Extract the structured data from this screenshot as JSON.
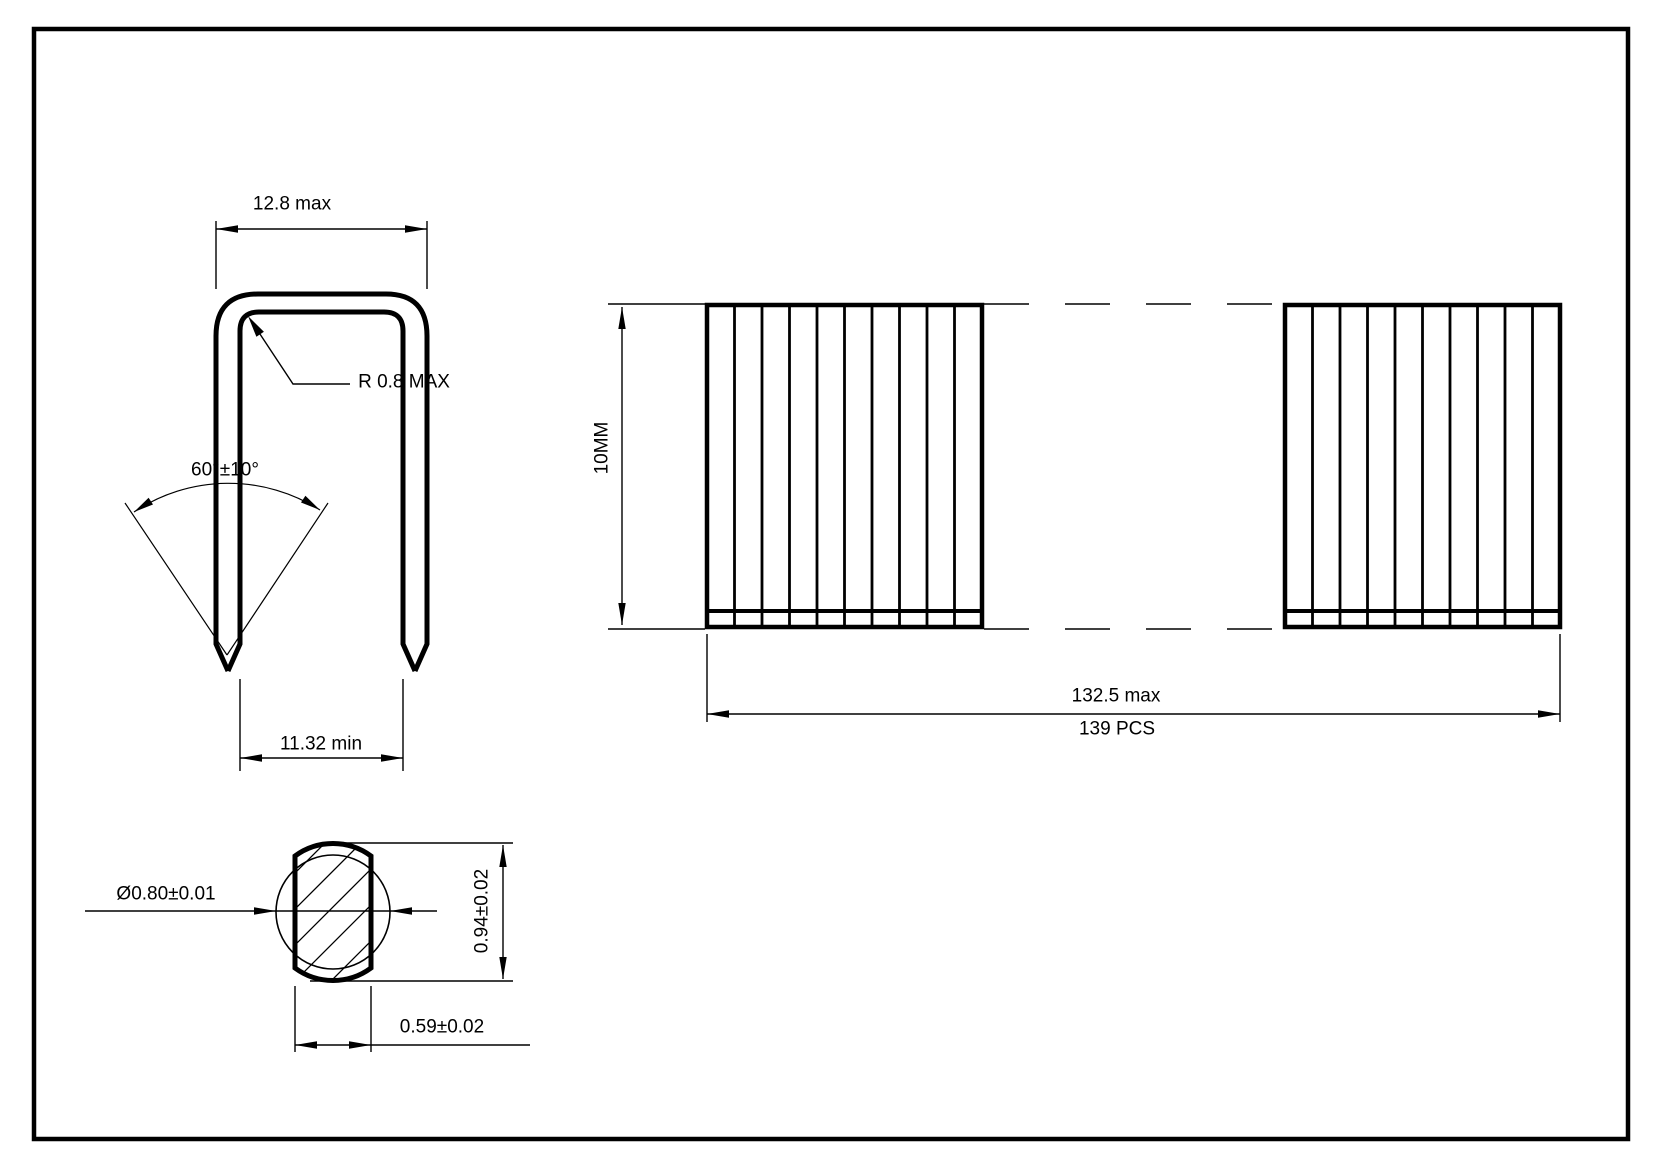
{
  "page": {
    "background_color": "#ffffff",
    "line_color": "#000000",
    "type_note": "staple technical drawing"
  },
  "views": {
    "staple_front": {
      "width_dim": "12.8 max",
      "corner_radius_dim": "R 0.8 MAX",
      "point_angle_dim": "60°±10°",
      "inner_width_dim": "11.32 min"
    },
    "staple_strip": {
      "height_dim": "10MM",
      "length_dim": "132.5 max",
      "piece_count": "139 PCS"
    },
    "wire_section": {
      "diameter_dim": "Ø0.80±0.01",
      "height_dim": "0.94±0.02",
      "width_dim": "0.59±0.02"
    }
  }
}
